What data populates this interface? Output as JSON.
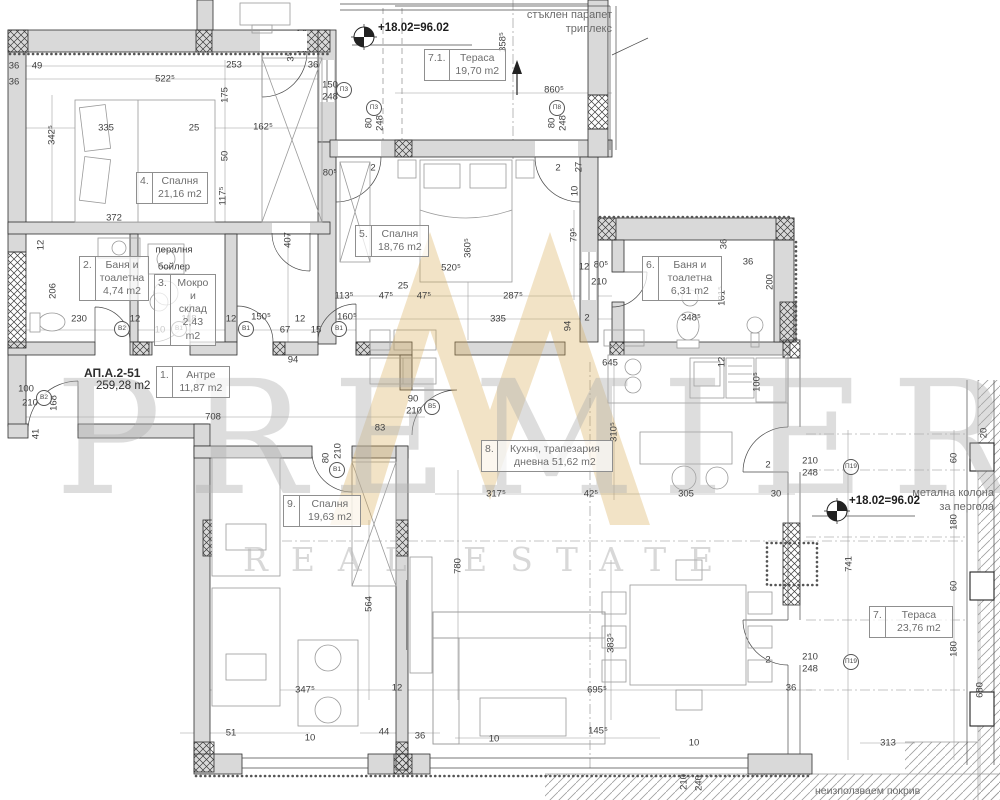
{
  "watermark": {
    "brand": "PREMIER",
    "sub": "REAL ESTATE",
    "gold": "#d8a94e",
    "gray": "#bdbdbd"
  },
  "apartment": {
    "id": "АП.А.2-51",
    "area": "259,28 m2"
  },
  "annotations": {
    "glass_railing": "стъклен парапет триплекс",
    "glass_railing_l1": "стъклен парапет",
    "glass_railing_l2": "триплекс",
    "pergola_l1": "метална колона",
    "pergola_l2": "за пергола",
    "unused_roof": "неизползваем покрив",
    "level_top": "+18.02=96.02",
    "level_right": "+18.02=96.02"
  },
  "rooms": [
    {
      "num": "4.",
      "name": "Спалня",
      "area": "21,16 m2",
      "x": 136,
      "y": 172,
      "w": 70
    },
    {
      "num": "2.",
      "name": "Баня и тоалетна",
      "area": "4,74 m2",
      "x": 79,
      "y": 256,
      "w": 68
    },
    {
      "num": "3.",
      "name": "Мокро и склад",
      "area": "2,43 m2",
      "x": 154,
      "y": 274,
      "w": 60
    },
    {
      "num": "5.",
      "name": "Спалня",
      "area": "18,76 m2",
      "x": 355,
      "y": 225,
      "w": 72
    },
    {
      "num": "7.1.",
      "name": "Тераса",
      "area": "19,70 m2",
      "x": 424,
      "y": 49,
      "w": 80
    },
    {
      "num": "6.",
      "name": "Баня и тоалетна",
      "area": "6,31 m2",
      "x": 642,
      "y": 256,
      "w": 78
    },
    {
      "num": "1.",
      "name": "Антре",
      "area": "11,87 m2",
      "x": 156,
      "y": 366,
      "w": 72
    },
    {
      "num": "8.",
      "name": "Кухня, трапезария дневна",
      "area": "51,62 m2",
      "x": 481,
      "y": 440,
      "w": 130
    },
    {
      "num": "9.",
      "name": "Спалня",
      "area": "19,63 m2",
      "x": 283,
      "y": 495,
      "w": 76
    },
    {
      "num": "7.",
      "name": "Тераса",
      "area": "23,76 m2",
      "x": 869,
      "y": 606,
      "w": 82
    }
  ],
  "door_window_tags": [
    {
      "t": "В2",
      "x": 122,
      "y": 329
    },
    {
      "t": "В1",
      "x": 179,
      "y": 329
    },
    {
      "t": "В1",
      "x": 246,
      "y": 329
    },
    {
      "t": "В1",
      "x": 339,
      "y": 329
    },
    {
      "t": "В5",
      "x": 432,
      "y": 407
    },
    {
      "t": "В1",
      "x": 337,
      "y": 470
    },
    {
      "t": "В2",
      "x": 44,
      "y": 398
    },
    {
      "t": "П3",
      "x": 344,
      "y": 90
    },
    {
      "t": "П3",
      "x": 374,
      "y": 108
    },
    {
      "t": "П8",
      "x": 557,
      "y": 108
    },
    {
      "t": "П19",
      "x": 851,
      "y": 467
    },
    {
      "t": "П19",
      "x": 851,
      "y": 662
    }
  ],
  "dims": [
    {
      "t": "36",
      "x": 14,
      "y": 66
    },
    {
      "t": "49",
      "x": 37,
      "y": 66
    },
    {
      "t": "36",
      "x": 14,
      "y": 82
    },
    {
      "t": "522⁵",
      "x": 165,
      "y": 79
    },
    {
      "t": "253",
      "x": 234,
      "y": 65
    },
    {
      "t": "36",
      "x": 313,
      "y": 65
    },
    {
      "t": "3⁵",
      "x": 291,
      "y": 57,
      "r": 1
    },
    {
      "t": "175",
      "x": 225,
      "y": 95,
      "r": 1
    },
    {
      "t": "150",
      "x": 330,
      "y": 85
    },
    {
      "t": "248",
      "x": 330,
      "y": 97
    },
    {
      "t": "335",
      "x": 106,
      "y": 128
    },
    {
      "t": "25",
      "x": 194,
      "y": 128
    },
    {
      "t": "162⁵",
      "x": 263,
      "y": 127
    },
    {
      "t": "50",
      "x": 225,
      "y": 156,
      "r": 1
    },
    {
      "t": "342⁵",
      "x": 52,
      "y": 135,
      "r": 1
    },
    {
      "t": "372",
      "x": 114,
      "y": 218
    },
    {
      "t": "117⁵",
      "x": 223,
      "y": 196,
      "r": 1
    },
    {
      "t": "407",
      "x": 288,
      "y": 240,
      "r": 1
    },
    {
      "t": "80⁵",
      "x": 330,
      "y": 173
    },
    {
      "t": "206",
      "x": 53,
      "y": 291,
      "r": 1
    },
    {
      "t": "12",
      "x": 41,
      "y": 245,
      "r": 1
    },
    {
      "t": "230",
      "x": 79,
      "y": 319
    },
    {
      "t": "12",
      "x": 135,
      "y": 319
    },
    {
      "t": "118",
      "x": 189,
      "y": 319
    },
    {
      "t": "10",
      "x": 160,
      "y": 330
    },
    {
      "t": "12",
      "x": 231,
      "y": 319
    },
    {
      "t": "150⁵",
      "x": 261,
      "y": 317
    },
    {
      "t": "67",
      "x": 285,
      "y": 330
    },
    {
      "t": "12",
      "x": 300,
      "y": 319
    },
    {
      "t": "15",
      "x": 316,
      "y": 330
    },
    {
      "t": "160⁵",
      "x": 347,
      "y": 317
    },
    {
      "t": "113⁵",
      "x": 344,
      "y": 296
    },
    {
      "t": "47⁵",
      "x": 386,
      "y": 296
    },
    {
      "t": "25",
      "x": 403,
      "y": 286
    },
    {
      "t": "47⁵",
      "x": 424,
      "y": 296
    },
    {
      "t": "287⁵",
      "x": 513,
      "y": 296
    },
    {
      "t": "335",
      "x": 498,
      "y": 319
    },
    {
      "t": "94",
      "x": 568,
      "y": 326,
      "r": 1
    },
    {
      "t": "520⁵",
      "x": 451,
      "y": 268
    },
    {
      "t": "360⁵",
      "x": 468,
      "y": 248,
      "r": 1
    },
    {
      "t": "2",
      "x": 373,
      "y": 168
    },
    {
      "t": "2",
      "x": 558,
      "y": 168
    },
    {
      "t": "79⁵",
      "x": 574,
      "y": 235,
      "r": 1
    },
    {
      "t": "10",
      "x": 575,
      "y": 191,
      "r": 1
    },
    {
      "t": "27",
      "x": 579,
      "y": 167,
      "r": 1
    },
    {
      "t": "12",
      "x": 584,
      "y": 267
    },
    {
      "t": "80⁵",
      "x": 601,
      "y": 265
    },
    {
      "t": "210",
      "x": 599,
      "y": 282
    },
    {
      "t": "358⁵",
      "x": 503,
      "y": 42,
      "r": 1
    },
    {
      "t": "860⁵",
      "x": 554,
      "y": 90
    },
    {
      "t": "80",
      "x": 369,
      "y": 123,
      "r": 1
    },
    {
      "t": "248",
      "x": 380,
      "y": 123,
      "r": 1
    },
    {
      "t": "80",
      "x": 552,
      "y": 123,
      "r": 1
    },
    {
      "t": "248",
      "x": 563,
      "y": 123,
      "r": 1
    },
    {
      "t": "36",
      "x": 724,
      "y": 244,
      "r": 1
    },
    {
      "t": "36",
      "x": 748,
      "y": 262
    },
    {
      "t": "200",
      "x": 770,
      "y": 282,
      "r": 1
    },
    {
      "t": "181⁵",
      "x": 722,
      "y": 296,
      "r": 1
    },
    {
      "t": "348⁵",
      "x": 691,
      "y": 318
    },
    {
      "t": "2",
      "x": 587,
      "y": 318
    },
    {
      "t": "645",
      "x": 610,
      "y": 363
    },
    {
      "t": "100⁵",
      "x": 757,
      "y": 382,
      "r": 1
    },
    {
      "t": "12",
      "x": 722,
      "y": 362,
      "r": 1
    },
    {
      "t": "94",
      "x": 293,
      "y": 360
    },
    {
      "t": "708",
      "x": 213,
      "y": 417
    },
    {
      "t": "90",
      "x": 413,
      "y": 399
    },
    {
      "t": "210",
      "x": 414,
      "y": 411
    },
    {
      "t": "83",
      "x": 380,
      "y": 428
    },
    {
      "t": "80",
      "x": 326,
      "y": 458,
      "r": 1
    },
    {
      "t": "210",
      "x": 338,
      "y": 451,
      "r": 1
    },
    {
      "t": "310⁵",
      "x": 614,
      "y": 432,
      "r": 1
    },
    {
      "t": "317⁵",
      "x": 496,
      "y": 494
    },
    {
      "t": "42⁵",
      "x": 591,
      "y": 494
    },
    {
      "t": "305",
      "x": 686,
      "y": 494
    },
    {
      "t": "30",
      "x": 776,
      "y": 494
    },
    {
      "t": "2",
      "x": 768,
      "y": 465
    },
    {
      "t": "210",
      "x": 810,
      "y": 461
    },
    {
      "t": "248",
      "x": 810,
      "y": 473
    },
    {
      "t": "2",
      "x": 768,
      "y": 660
    },
    {
      "t": "210",
      "x": 810,
      "y": 657
    },
    {
      "t": "248",
      "x": 810,
      "y": 669
    },
    {
      "t": "36",
      "x": 791,
      "y": 688
    },
    {
      "t": "741",
      "x": 849,
      "y": 564,
      "r": 1
    },
    {
      "t": "780",
      "x": 458,
      "y": 566,
      "r": 1
    },
    {
      "t": "383⁵",
      "x": 611,
      "y": 643,
      "r": 1
    },
    {
      "t": "695⁵",
      "x": 597,
      "y": 690
    },
    {
      "t": "564",
      "x": 369,
      "y": 604,
      "r": 1
    },
    {
      "t": "347⁵",
      "x": 305,
      "y": 690
    },
    {
      "t": "12",
      "x": 397,
      "y": 688
    },
    {
      "t": "44",
      "x": 384,
      "y": 732
    },
    {
      "t": "36",
      "x": 420,
      "y": 736
    },
    {
      "t": "10",
      "x": 494,
      "y": 739
    },
    {
      "t": "145⁵",
      "x": 598,
      "y": 731
    },
    {
      "t": "10",
      "x": 694,
      "y": 743
    },
    {
      "t": "210",
      "x": 684,
      "y": 782,
      "r": 1
    },
    {
      "t": "240",
      "x": 699,
      "y": 783,
      "r": 1
    },
    {
      "t": "51",
      "x": 231,
      "y": 733
    },
    {
      "t": "10",
      "x": 310,
      "y": 738
    },
    {
      "t": "100",
      "x": 26,
      "y": 389
    },
    {
      "t": "210",
      "x": 30,
      "y": 403
    },
    {
      "t": "168",
      "x": 54,
      "y": 403,
      "r": 1
    },
    {
      "t": "41",
      "x": 36,
      "y": 434,
      "r": 1
    },
    {
      "t": "60",
      "x": 954,
      "y": 458,
      "r": 1
    },
    {
      "t": "180",
      "x": 954,
      "y": 522,
      "r": 1
    },
    {
      "t": "60",
      "x": 954,
      "y": 586,
      "r": 1
    },
    {
      "t": "180",
      "x": 954,
      "y": 649,
      "r": 1
    },
    {
      "t": "680",
      "x": 980,
      "y": 690,
      "r": 1
    },
    {
      "t": "20",
      "x": 984,
      "y": 433,
      "r": 1
    },
    {
      "t": "313",
      "x": 888,
      "y": 743
    },
    {
      "t": "пералня",
      "x": 174,
      "y": 250
    },
    {
      "t": "бойлер",
      "x": 174,
      "y": 267
    }
  ]
}
